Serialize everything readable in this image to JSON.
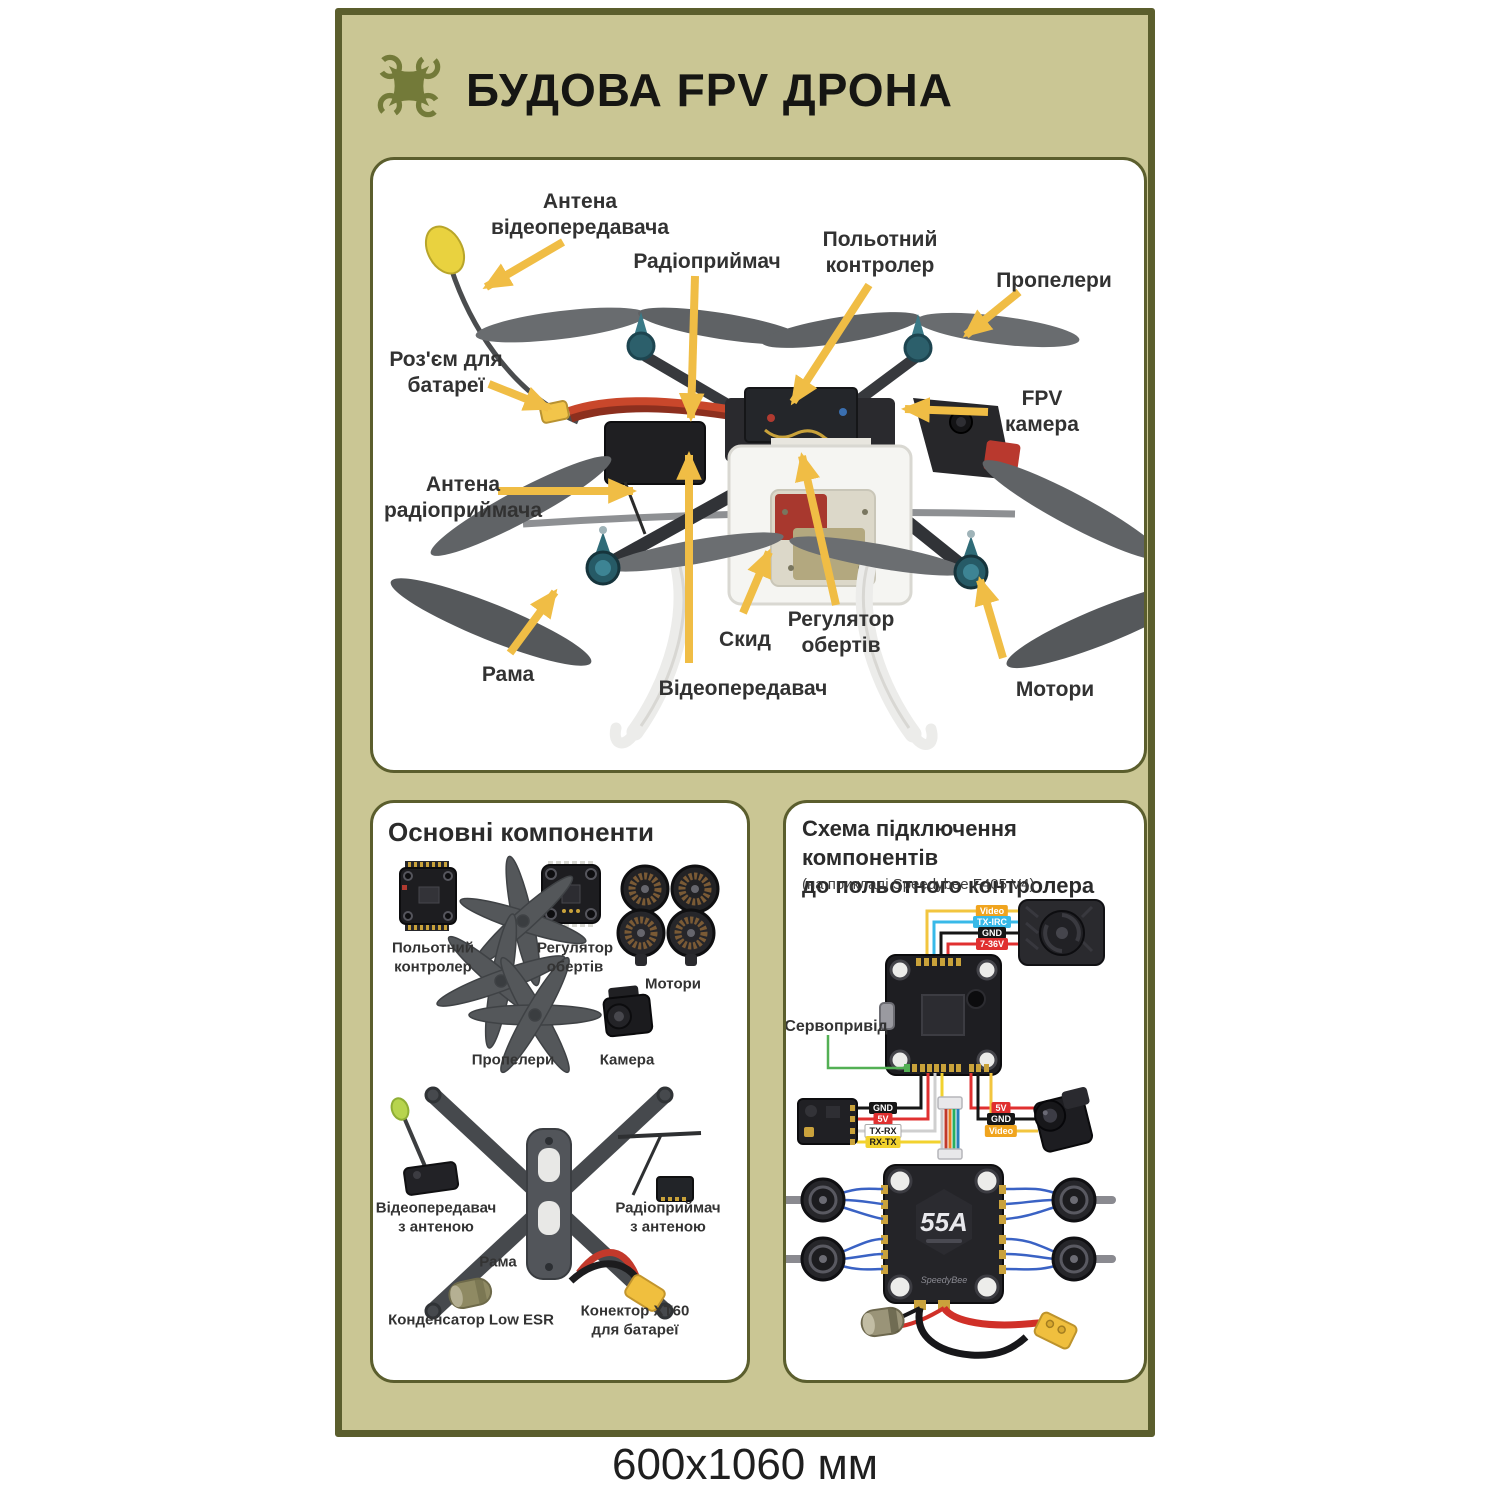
{
  "poster": {
    "title": "БУДОВА FPV ДРОНА",
    "size_caption": "600x1060 мм"
  },
  "drone_diagram": {
    "labels": {
      "antena_video": "Антена\nвідеопередавача",
      "radiopryimach": "Радіоприймач",
      "polotnyi_kontroler": "Польотний\nконтролер",
      "propelery": "Пропелери",
      "rozyem": "Роз'єм для\nбатареї",
      "fpv_camera": "FPV камера",
      "antena_radio": "Антена\nрадіоприймача",
      "rama": "Рама",
      "skyd": "Скид",
      "rehuliator": "Регулятор\nобертів",
      "videoperedavach": "Відеопередавач",
      "motory": "Мотори"
    }
  },
  "components_panel": {
    "title": "Основні компоненти",
    "labels": {
      "fc": "Польотний\nконтролер",
      "esc": "Регулятор\nобертів",
      "motors": "Мотори",
      "props": "Пропелери",
      "camera": "Камера",
      "vtx": "Відеопередавач\nз антеною",
      "rx": "Радіоприймач\nз антеною",
      "frame": "Рама",
      "capacitor": "Конденсатор Low ESR",
      "xt60": "Конектор XT60 для батареї"
    }
  },
  "wiring_panel": {
    "title": "Схема підключення компонентів\nдо польотного контролера",
    "subtitle": "(на прикладі Speedybee F405 V4)",
    "servo_label": "Сервопривід",
    "vtx_wires": [
      "Video",
      "TX-IRC",
      "GND",
      "7-36V"
    ],
    "rx_wires": [
      "GND",
      "5V",
      "TX-RX",
      "RX-TX"
    ],
    "camera_wires": [
      "5V",
      "GND",
      "Video"
    ],
    "esc_amp": "55A",
    "esc_brand": "SpeedyBee"
  },
  "colors": {
    "poster_bg": "#cac694",
    "border_olive": "#5b5e2d",
    "arrow_gold": "#f0bd45",
    "badge_orange": "#f0a41e",
    "badge_blue": "#38b9e8",
    "badge_red": "#e03030",
    "badge_yellow": "#f2d22e"
  }
}
